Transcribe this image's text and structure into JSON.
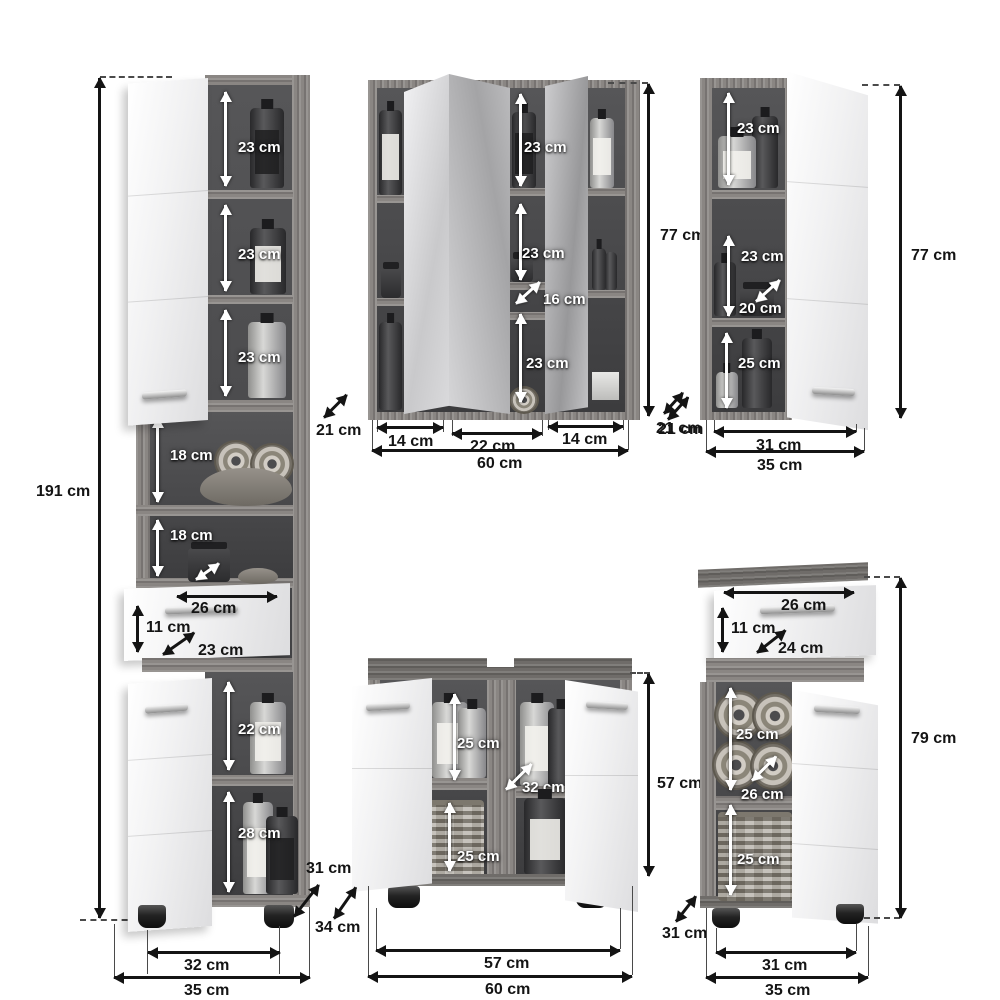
{
  "colors": {
    "background": "#ffffff",
    "wood_gray": "#8a8683",
    "interior_dark": "#3c3c3e",
    "panel_white": "#f1f1f2",
    "label_light": "#ffffff",
    "label_dark": "#141414"
  },
  "tall_cabinet": {
    "total_height": "191 cm",
    "compartment_1": "23 cm",
    "compartment_2": "23 cm",
    "compartment_3": "23 cm",
    "open_shelf_1": "18 cm",
    "open_shelf_2": "18 cm",
    "drawer_width": "26 cm",
    "drawer_height": "11 cm",
    "drawer_depth": "23 cm",
    "lower_compartment_1": "22 cm",
    "lower_compartment_2": "28 cm",
    "depth": "31 cm",
    "inner_width": "32 cm",
    "outer_width": "35 cm"
  },
  "mirror_cabinet": {
    "total_height": "77 cm",
    "depth_left": "21 cm",
    "depth_right": "21 cm",
    "compartment_1": "23 cm",
    "compartment_2": "23 cm",
    "compartment_3": "16 cm",
    "compartment_4": "23 cm",
    "section_width_left": "14 cm",
    "section_width_center": "22 cm",
    "section_width_right": "14 cm",
    "total_width": "60 cm"
  },
  "wall_cabinet": {
    "total_height": "77 cm",
    "compartment_1": "23 cm",
    "compartment_2": "23 cm",
    "shelf_depth": "20 cm",
    "compartment_3": "25 cm",
    "depth": "21 cm",
    "inner_width": "31 cm",
    "outer_width": "35 cm"
  },
  "sink_cabinet": {
    "total_height": "57 cm",
    "upper_compartment": "25 cm",
    "inner_depth": "32 cm",
    "lower_compartment": "25 cm",
    "depth": "34 cm",
    "inner_width": "57 cm",
    "outer_width": "60 cm"
  },
  "floor_cabinet": {
    "total_height": "79 cm",
    "drawer_width": "26 cm",
    "drawer_height": "11 cm",
    "drawer_depth": "24 cm",
    "upper_compartment": "25 cm",
    "shelf_depth": "26 cm",
    "lower_compartment": "25 cm",
    "depth": "31 cm",
    "inner_width": "31 cm",
    "outer_width": "35 cm"
  }
}
